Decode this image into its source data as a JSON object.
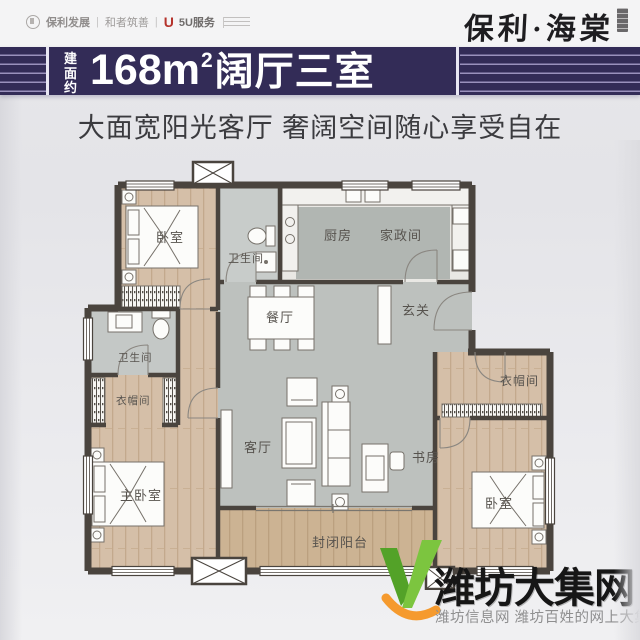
{
  "header": {
    "logo_poly": "保利发展",
    "divider": "|",
    "logo_hezhe": "和者筑善",
    "logo_5u_glyph": "U",
    "logo_5u": "5U服务",
    "brand": "保利·海棠"
  },
  "banner": {
    "area_prefix": "建面约",
    "area_number": "168m",
    "area_sup": "2",
    "area_suffix": "阔厅三室"
  },
  "subtitle": "大面宽阳光客厅 奢阔空间随心享受自在",
  "floorplan": {
    "rooms": {
      "bedroom_top_left": "卧室",
      "bath_top": "卫生间",
      "kitchen": "厨房",
      "housekeeping": "家政间",
      "foyer": "玄关",
      "dining": "餐厅",
      "living": "客厅",
      "study": "书房",
      "bath_left": "卫生间",
      "cloak_left": "衣帽间",
      "master_bedroom": "主卧室",
      "cloak_right": "衣帽间",
      "bedroom_right": "卧室",
      "balcony": "封闭阳台"
    }
  },
  "watermark": {
    "site_name": "潍坊大集网",
    "tagline": "潍坊信息网 潍坊百姓的网上大集"
  },
  "colors": {
    "banner_bg": "#332c57",
    "banner_line": "#9a91bc",
    "wall": "#4a443e",
    "wood_floor": "#d5bfa8",
    "gray_floor": "#bdc1be",
    "watermark_green": "#62b32e",
    "watermark_orange": "#f59a2e",
    "logo_red": "#b5332c"
  }
}
